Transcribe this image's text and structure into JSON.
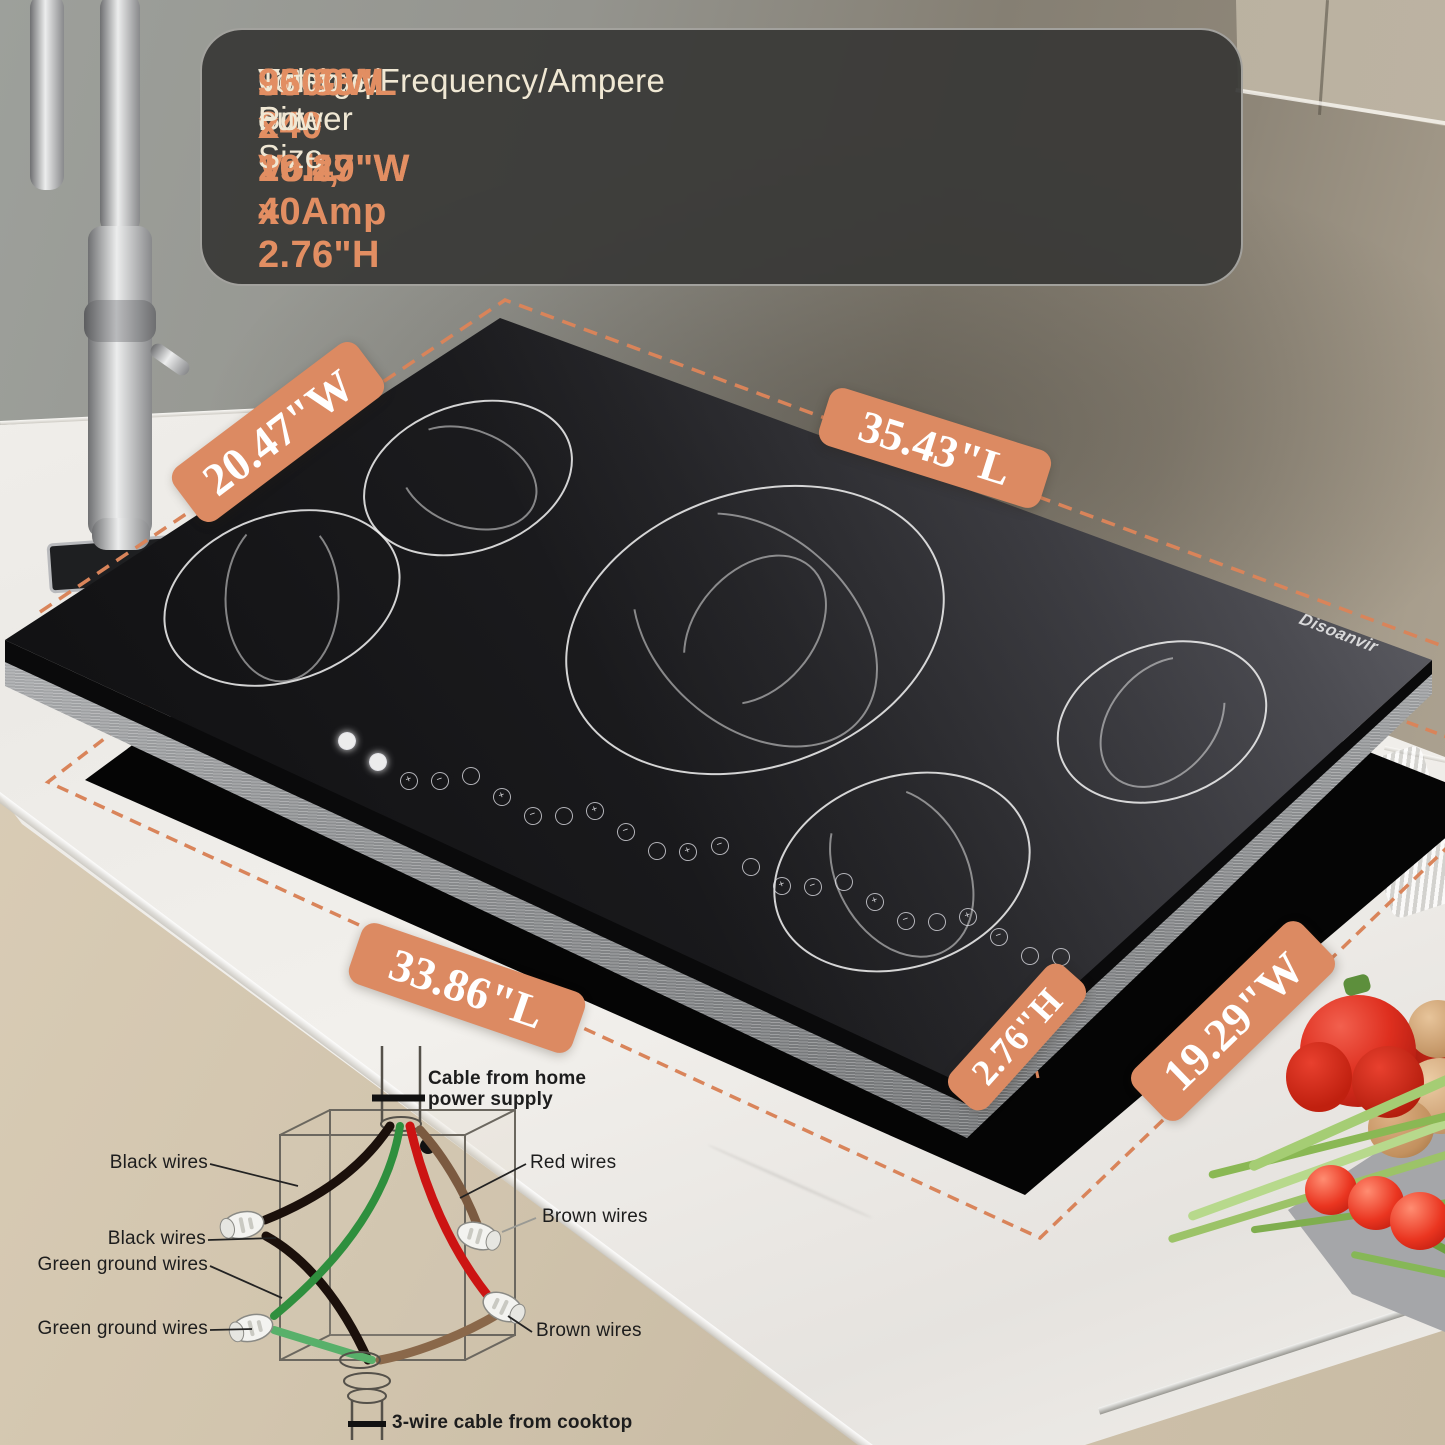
{
  "product": {
    "brand": "Disoanvir"
  },
  "spec_panel": {
    "cooktop_size_label": "Cooktop Size",
    "cooktop_size_value": "35.43\"L x 20.47\"W x 2.76\"H",
    "electrical_label": "Voltage/Frequency/Ampere",
    "electrical_value": "220-240 Volt, 40Amp",
    "cutout_size_label": "Cut-out Size",
    "cutout_size_value": "33.86\"L x 19.29\"W",
    "power_label": "Totao Power",
    "power_value": "9600W"
  },
  "badges": {
    "top_width": "20.47\"W",
    "top_length": "35.43\"L",
    "cutout_length": "33.86\"L",
    "height": "2.76\"H",
    "cutout_width": "19.29\"W"
  },
  "wiring": {
    "labels": {
      "supply": "Cable from home power supply",
      "black1": "Black wires",
      "black2": "Black wires",
      "green1": "Green ground wires",
      "green2": "Green ground wires",
      "red": "Red wires",
      "brown1": "Brown wires",
      "brown2": "Brown wires",
      "cooktop_cable": "3-wire cable from cooktop"
    },
    "wire_colors": {
      "black": "#1b100b",
      "red": "#cc1413",
      "green": "#2f8f3e",
      "brown": "#7b5a40"
    }
  },
  "cooktop": {
    "burner_count": 5,
    "controls": [
      "",
      "",
      "+",
      "−",
      "",
      "+",
      "−",
      "",
      "+",
      "−",
      "",
      "+",
      "−",
      "",
      "+",
      "−",
      "",
      "+",
      "−",
      "",
      "+",
      "−",
      "",
      ""
    ]
  },
  "colors": {
    "badge_accent": "#DC8A62",
    "orange_text": "#E28E62",
    "panel_bg": "#3A3A38",
    "cream_text": "#F0E8D4",
    "dash_line": "#D9845A"
  }
}
